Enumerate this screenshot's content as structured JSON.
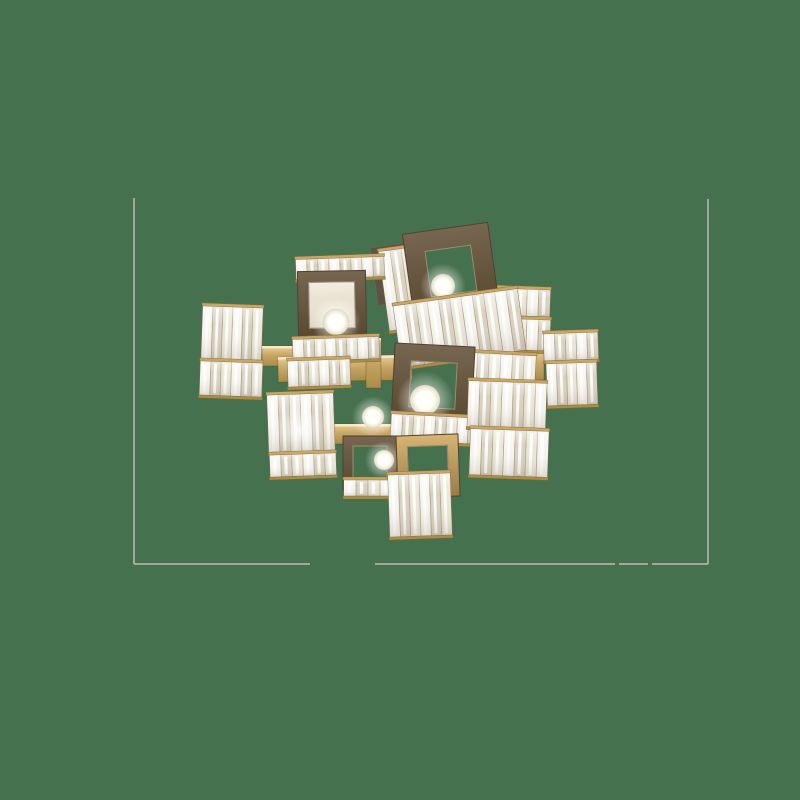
{
  "scene": {
    "canvas": {
      "width": 800,
      "height": 800,
      "background": "#46714F"
    },
    "photo_frame": {
      "color": "#b3b0ac",
      "stroke_width": 1.7,
      "left": {
        "x": 134,
        "y1": 198,
        "y2": 564
      },
      "right": {
        "x": 708,
        "y1": 199,
        "y2": 564
      },
      "bottom": {
        "y": 564,
        "segments": [
          [
            134,
            310
          ],
          [
            375,
            615
          ],
          [
            619,
            648
          ],
          [
            652,
            708
          ]
        ]
      }
    },
    "palette": {
      "brass_light": "#e9d09b",
      "brass_mid": "#c8a766",
      "brass_deep": "#a98c48",
      "brass_dark": "#7c6232",
      "ring_dark_1": "#776650",
      "ring_dark_2": "#57482f",
      "ring_gold_1": "#d6b472",
      "ring_gold_2": "#9b7c49",
      "crystal_base": "#efe9dc",
      "crystal_tone1": "#f8f5ee",
      "crystal_tone2": "#d9d2c1",
      "crystal_tone3": "#ece6d8",
      "crystal_highlight": "#ffffff",
      "crystal_sep": "#8f8268",
      "crystal_edge": "#7d6e55",
      "panel_light": "#eae3d2",
      "panel_dark": "#5d5244",
      "bulb_core": "#ffffff",
      "bulb_mid": "#fffef6",
      "bulb_rim": "#e3dcc6"
    },
    "chandelier": {
      "elements": [
        {
          "t": "arm",
          "x": 262,
          "y": 346,
          "w": 36,
          "h": 20,
          "r": 0
        },
        {
          "t": "arm",
          "x": 278,
          "y": 356,
          "w": 134,
          "h": 25,
          "r": -1
        },
        {
          "t": "arm",
          "x": 366,
          "y": 338,
          "w": 15,
          "h": 50,
          "r": 0
        },
        {
          "t": "arm",
          "x": 389,
          "y": 248,
          "w": 12,
          "h": 58,
          "r": -7
        },
        {
          "t": "arm",
          "x": 322,
          "y": 424,
          "w": 72,
          "h": 20,
          "r": 0
        },
        {
          "t": "arm",
          "x": 446,
          "y": 428,
          "w": 70,
          "h": 18,
          "r": 1
        },
        {
          "t": "arm",
          "x": 394,
          "y": 438,
          "w": 14,
          "h": 42,
          "r": 0
        },
        {
          "t": "arm",
          "x": 440,
          "y": 336,
          "w": 28,
          "h": 22,
          "r": -4
        },
        {
          "t": "arm",
          "x": 520,
          "y": 350,
          "w": 24,
          "h": 30,
          "r": 0
        },
        {
          "t": "arm",
          "x": 480,
          "y": 366,
          "w": 18,
          "h": 26,
          "r": 0
        },
        {
          "t": "panel",
          "x": 374,
          "y": 244,
          "w": 52,
          "h": 58,
          "r": -8,
          "dark": true
        },
        {
          "t": "band",
          "x": 492,
          "y": 287,
          "w": 58,
          "h": 31,
          "r": 2,
          "n": 5
        },
        {
          "t": "band",
          "x": 491,
          "y": 317,
          "w": 59,
          "h": 35,
          "r": 2,
          "n": 5
        },
        {
          "t": "band",
          "x": 544,
          "y": 331,
          "w": 54,
          "h": 31,
          "r": -2,
          "n": 5
        },
        {
          "t": "band",
          "x": 547,
          "y": 361,
          "w": 50,
          "h": 46,
          "r": -2,
          "n": 5
        },
        {
          "t": "band",
          "x": 384,
          "y": 247,
          "w": 34,
          "h": 84,
          "r": -8,
          "n": 3
        },
        {
          "t": "ring",
          "cx": 451,
          "cy": 271,
          "size": 86,
          "inner": 46,
          "r": -8
        },
        {
          "t": "bulb",
          "cx": 443,
          "cy": 286,
          "rad": 12
        },
        {
          "t": "band",
          "x": 397,
          "y": 295,
          "w": 125,
          "h": 66,
          "r": -8,
          "n": 11
        },
        {
          "t": "band",
          "x": 296,
          "y": 256,
          "w": 88,
          "h": 24,
          "r": -2,
          "n": 8
        },
        {
          "t": "panel",
          "x": 302,
          "y": 276,
          "w": 62,
          "h": 62,
          "r": -1
        },
        {
          "t": "ring",
          "cx": 332,
          "cy": 305,
          "size": 68,
          "inner": 46,
          "r": -1
        },
        {
          "t": "bulb",
          "cx": 336,
          "cy": 322,
          "rad": 13
        },
        {
          "t": "band",
          "x": 293,
          "y": 336,
          "w": 86,
          "h": 26,
          "r": -2,
          "n": 8
        },
        {
          "t": "band",
          "x": 288,
          "y": 358,
          "w": 62,
          "h": 30,
          "r": -2,
          "n": 6
        },
        {
          "t": "band",
          "x": 202,
          "y": 305,
          "w": 60,
          "h": 58,
          "r": 2,
          "n": 6
        },
        {
          "t": "band",
          "x": 200,
          "y": 360,
          "w": 62,
          "h": 38,
          "r": 2,
          "n": 6
        },
        {
          "t": "band",
          "x": 268,
          "y": 392,
          "w": 66,
          "h": 62,
          "r": -2,
          "n": 6
        },
        {
          "t": "band",
          "x": 270,
          "y": 452,
          "w": 66,
          "h": 26,
          "r": -2,
          "n": 6
        },
        {
          "t": "glow",
          "cx": 299,
          "cy": 430,
          "rad": 24
        },
        {
          "t": "band",
          "x": 464,
          "y": 352,
          "w": 70,
          "h": 82,
          "r": 3,
          "n": 6
        },
        {
          "t": "ring",
          "cx": 433,
          "cy": 385,
          "size": 80,
          "inner": 46,
          "r": 3
        },
        {
          "t": "bulb",
          "cx": 425,
          "cy": 400,
          "rad": 15
        },
        {
          "t": "band",
          "x": 391,
          "y": 414,
          "w": 88,
          "h": 30,
          "r": 3,
          "n": 8
        },
        {
          "t": "band",
          "x": 468,
          "y": 380,
          "w": 78,
          "h": 50,
          "r": 2,
          "n": 7
        },
        {
          "t": "band",
          "x": 470,
          "y": 428,
          "w": 78,
          "h": 50,
          "r": 2,
          "n": 7
        },
        {
          "t": "bulb",
          "cx": 373,
          "cy": 417,
          "rad": 11
        },
        {
          "t": "ring",
          "cx": 370,
          "cy": 463,
          "size": 54,
          "inner": 34,
          "r": 0
        },
        {
          "t": "bulb",
          "cx": 384,
          "cy": 460,
          "rad": 10
        },
        {
          "t": "band",
          "x": 344,
          "y": 478,
          "w": 48,
          "h": 20,
          "r": 0,
          "n": 4
        },
        {
          "t": "ring",
          "cx": 428,
          "cy": 466,
          "size": 62,
          "inner": 40,
          "r": -2,
          "gold": true
        },
        {
          "t": "band",
          "x": 389,
          "y": 472,
          "w": 62,
          "h": 66,
          "r": -2,
          "n": 6
        }
      ]
    }
  }
}
